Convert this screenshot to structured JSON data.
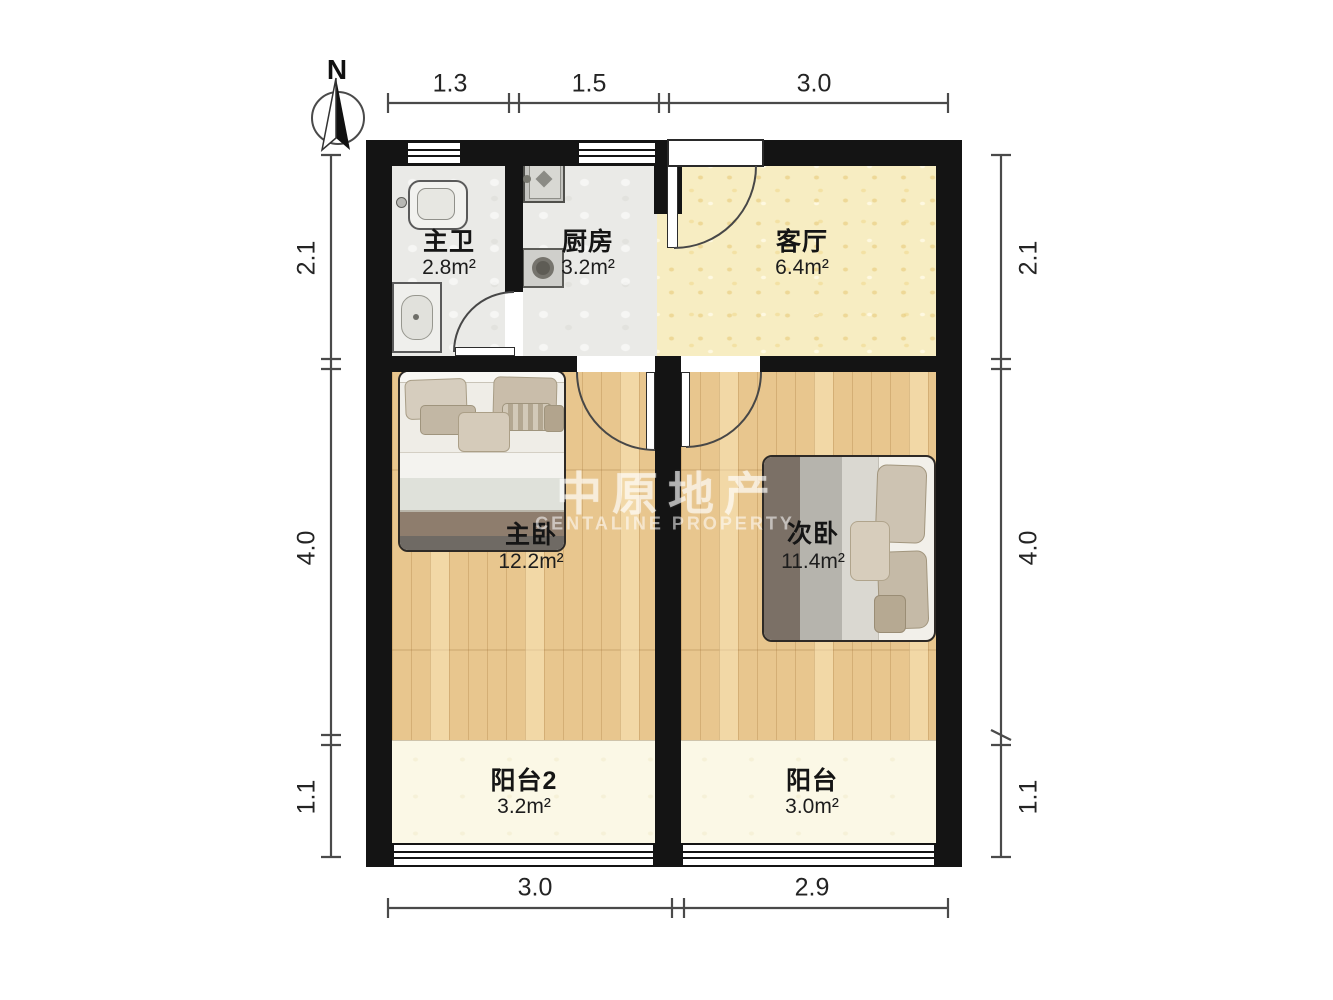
{
  "compass": {
    "north_label": "N"
  },
  "watermark": {
    "title": "中原地产",
    "subtitle": "CENTALINE PROPERTY"
  },
  "rooms": {
    "master_bath": {
      "name": "主卫",
      "area": "2.8m²"
    },
    "kitchen": {
      "name": "厨房",
      "area": "3.2m²"
    },
    "living_room": {
      "name": "客厅",
      "area": "6.4m²"
    },
    "master_bedroom": {
      "name": "主卧",
      "area": "12.2m²"
    },
    "second_bedroom": {
      "name": "次卧",
      "area": "11.4m²"
    },
    "balcony2": {
      "name": "阳台2",
      "area": "3.2m²"
    },
    "balcony": {
      "name": "阳台",
      "area": "3.0m²"
    }
  },
  "dimensions": {
    "top": [
      "1.3",
      "1.5",
      "3.0"
    ],
    "bottom": [
      "3.0",
      "2.9"
    ],
    "left": [
      "2.1",
      "4.0",
      "1.1"
    ],
    "right": [
      "2.1",
      "4.0",
      "1.1"
    ]
  },
  "colors": {
    "wall": "#141414",
    "wood_floor": "#e8c68e",
    "living_floor": "#f7edc2",
    "tile_floor": "#eaeae7",
    "balcony_floor": "#fbf8e6"
  }
}
